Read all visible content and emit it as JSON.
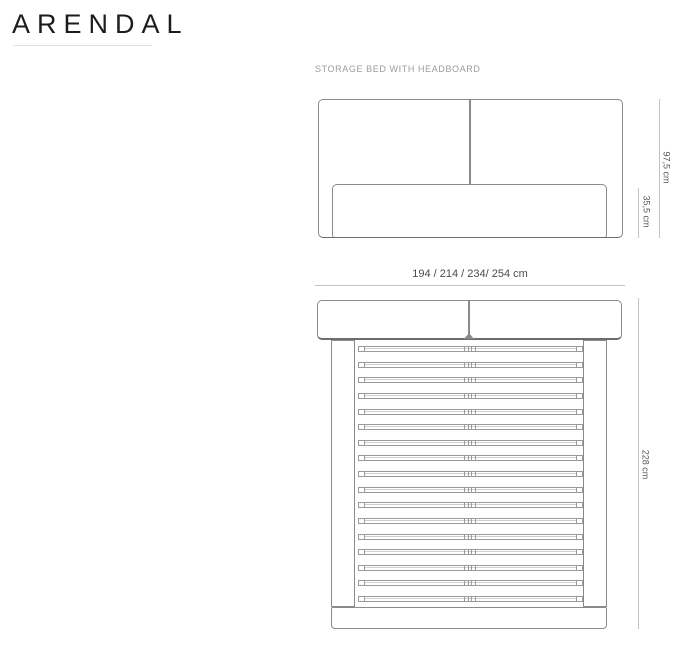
{
  "brand": {
    "title": "ARENDAL"
  },
  "drawing": {
    "subtitle": "STORAGE BED WITH HEADBOARD",
    "front_view": {
      "dim_total_height": "97,5 cm",
      "dim_base_height": "35,5 cm"
    },
    "top_view": {
      "dim_width_variants": "194 / 214 / 234/ 254 cm",
      "dim_length": "228 cm",
      "slat_count": 17
    },
    "colors": {
      "title_text": "#1c1c1c",
      "subtitle_text": "#9c9c9c",
      "outline": "#8a8a8a",
      "outline_shadow": "#6d6d6d",
      "slat_line": "#9a9a9a",
      "dimension_line": "#c3c3c3",
      "dimension_text": "#575757",
      "underline": "#e0e0e0",
      "background": "#ffffff"
    }
  }
}
